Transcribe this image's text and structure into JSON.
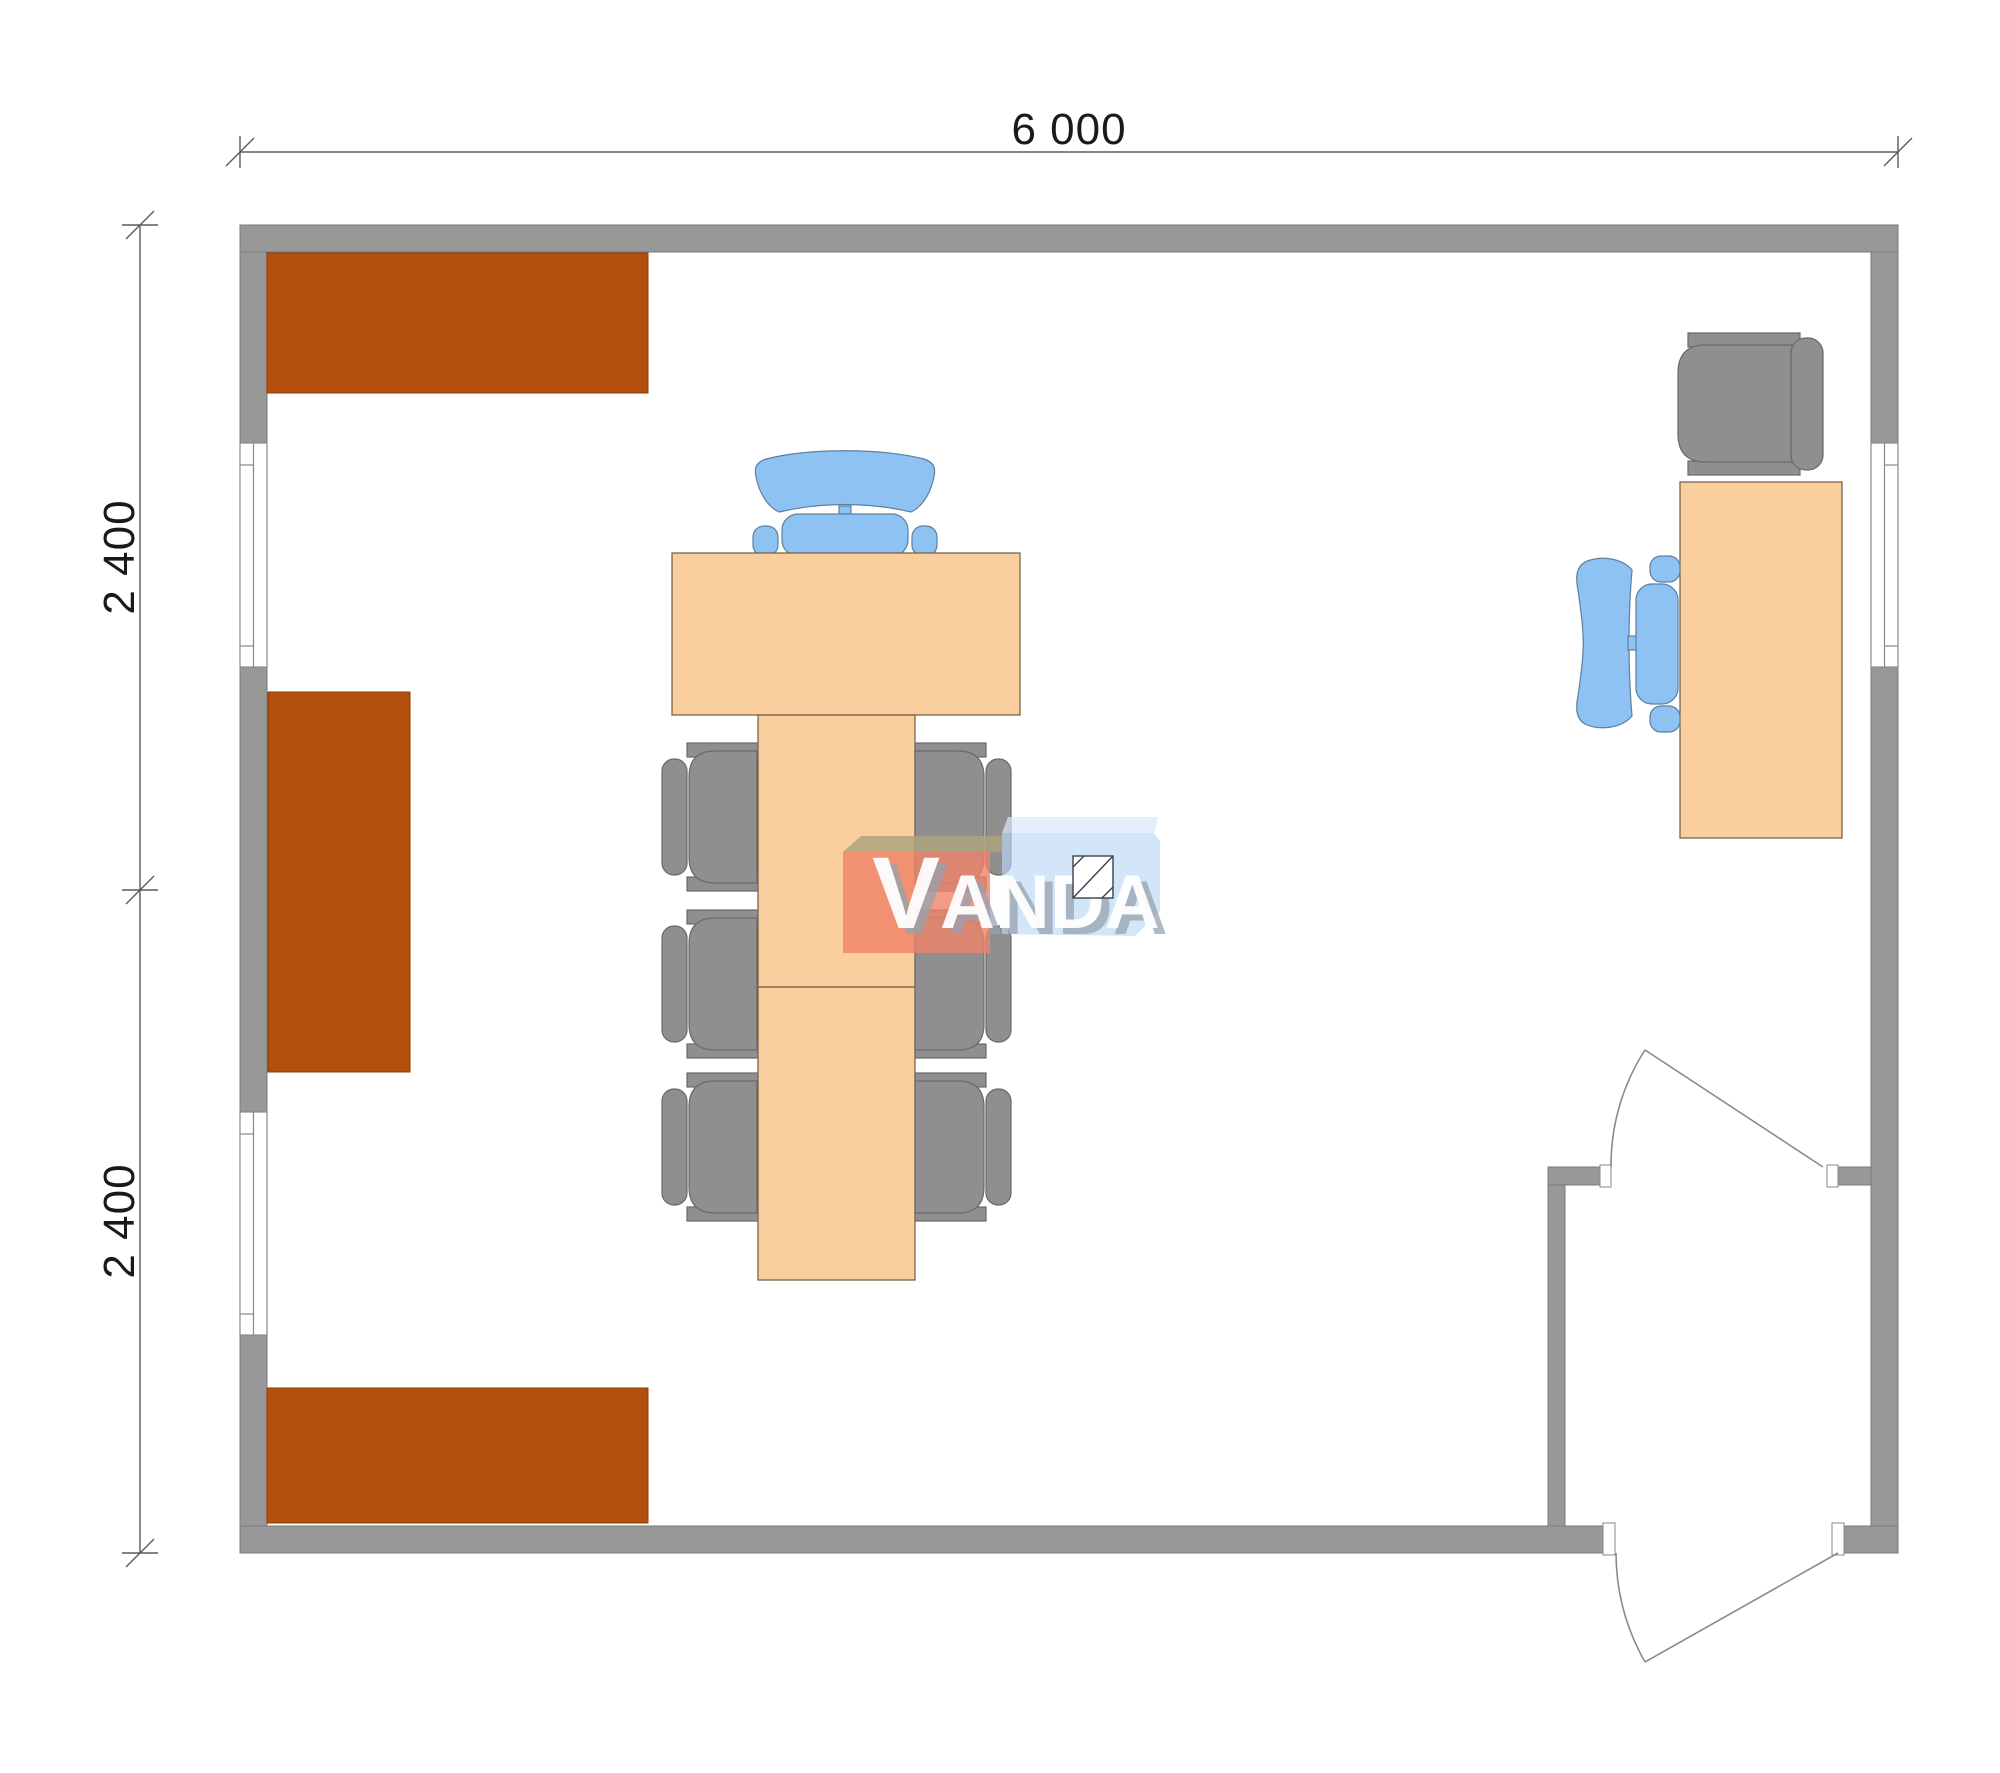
{
  "plan": {
    "type": "office-floor-plan",
    "legend": [
      "wall-cabinet",
      "conference-desk",
      "conference-table",
      "executive-office-chair",
      "side-chair",
      "work-desk",
      "lounge-chair",
      "window",
      "door-swing",
      "vestibule"
    ]
  },
  "dimensions": {
    "width": {
      "label": "6 000"
    },
    "height_top": {
      "label": "2 400"
    },
    "height_bottom": {
      "label": "2 400"
    }
  },
  "watermark": {
    "text": "VANDA",
    "initial": "V",
    "rest": "ANDA"
  },
  "colors": {
    "wall": "#989898",
    "wall_edge": "#7a7a7a",
    "window_frame": "#8a8a8a",
    "door_line": "#8a8a8a",
    "cabinet": "#b3500e",
    "cabinet_edge": "#8c3c08",
    "desk": "#fbce9d",
    "desk_edge": "#6f5b40",
    "chair_gray": "#8f8f8f",
    "chair_gray_edge": "#696969",
    "chair_blue": "#8ec2f3",
    "chair_blue_edge": "#5c7f9e",
    "dim_line": "#5a5a5a",
    "dim_text": "#1a1a1a",
    "logo_red": "#ef8268",
    "logo_olive": "#aea37c",
    "logo_blue_front": "#bcd8f6",
    "logo_blue_top": "#d8e8fb",
    "logo_text": "#ffffff",
    "logo_text_shadow": "#97a2ae"
  }
}
